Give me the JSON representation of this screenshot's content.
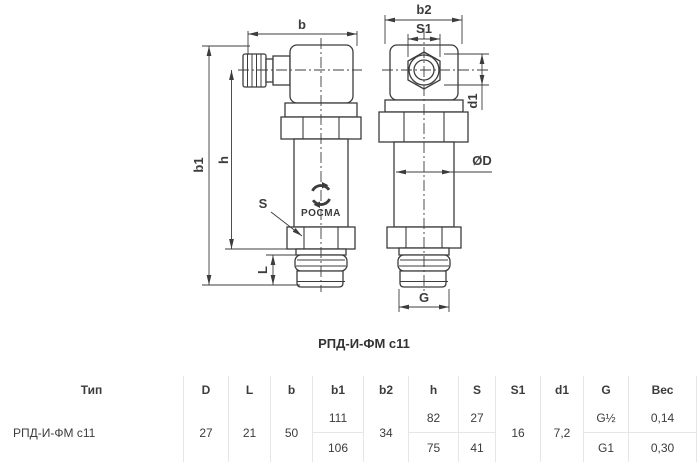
{
  "drawing": {
    "caption": "РПД-И-ФМ с11",
    "brand": "РОСМА",
    "dimension_labels": {
      "b": "b",
      "b1": "b1",
      "h": "h",
      "S": "S",
      "L": "L",
      "b2": "b2",
      "S1": "S1",
      "d1": "d1",
      "D": "ØD",
      "G": "G"
    }
  },
  "table": {
    "columns": [
      {
        "key": "type",
        "label": "Тип",
        "value": "РПД-И-ФМ с11"
      },
      {
        "key": "D",
        "label": "D",
        "value": "27"
      },
      {
        "key": "L",
        "label": "L",
        "value": "21"
      },
      {
        "key": "b",
        "label": "b",
        "value": "50"
      },
      {
        "key": "b1",
        "label": "b1",
        "value_top": "111",
        "value_bottom": "106"
      },
      {
        "key": "b2",
        "label": "b2",
        "value": "34"
      },
      {
        "key": "h",
        "label": "h",
        "value_top": "82",
        "value_bottom": "75"
      },
      {
        "key": "S",
        "label": "S",
        "value_top": "27",
        "value_bottom": "41"
      },
      {
        "key": "S1",
        "label": "S1",
        "value": "16"
      },
      {
        "key": "d1",
        "label": "d1",
        "value": "7,2"
      },
      {
        "key": "G",
        "label": "G",
        "value_top": "G½",
        "value_bottom": "G1"
      },
      {
        "key": "Ves",
        "label": "Вес",
        "value_top": "0,14",
        "value_bottom": "0,30"
      }
    ]
  },
  "colors": {
    "line": "#3c3c3c",
    "grid": "#e6e6e6",
    "background": "#ffffff"
  }
}
